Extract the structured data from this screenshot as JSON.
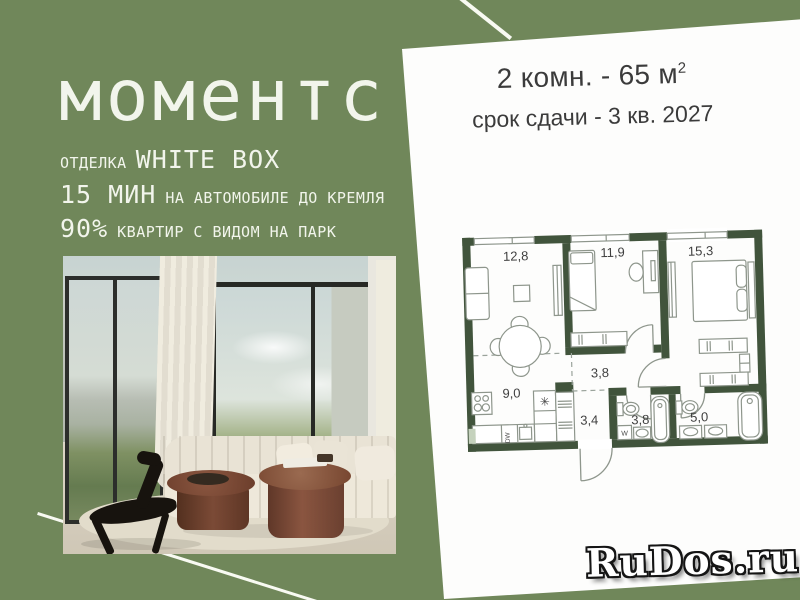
{
  "brand": {
    "logo": "моментс",
    "finish_label": "ОТДЕЛКА",
    "finish_value": "WHITE BOX",
    "drive_value": "15 МИН",
    "drive_label": "НА АВТОМОБИЛЕ ДО КРЕМЛЯ",
    "view_value": "90%",
    "view_label": "КВАРТИР С ВИДОМ НА ПАРК"
  },
  "offer": {
    "rooms_area": "2 комн. - 65 м",
    "area_sup": "2",
    "deadline": "срок сдачи - 3 кв. 2027"
  },
  "floorplan": {
    "rooms": [
      {
        "name": "living-room",
        "area": "12,8"
      },
      {
        "name": "bedroom-small",
        "area": "11,9"
      },
      {
        "name": "bedroom-master",
        "area": "15,3"
      },
      {
        "name": "kitchen",
        "area": "9,0"
      },
      {
        "name": "hallway",
        "area": "3,8"
      },
      {
        "name": "entry",
        "area": "3,4"
      },
      {
        "name": "bathroom",
        "area": "3,8"
      },
      {
        "name": "bathroom-master",
        "area": "5,0"
      }
    ],
    "appliance_labels": {
      "washer": "W",
      "dishwasher": "DW",
      "boiler": "✳"
    }
  },
  "watermark": "RuDos.ru",
  "colors": {
    "background_green": "#70875A",
    "panel_white": "#FDFDFC",
    "wall_green": "#41543C",
    "text_light": "#F2F5EC",
    "text_dark": "#3B3B3B"
  }
}
